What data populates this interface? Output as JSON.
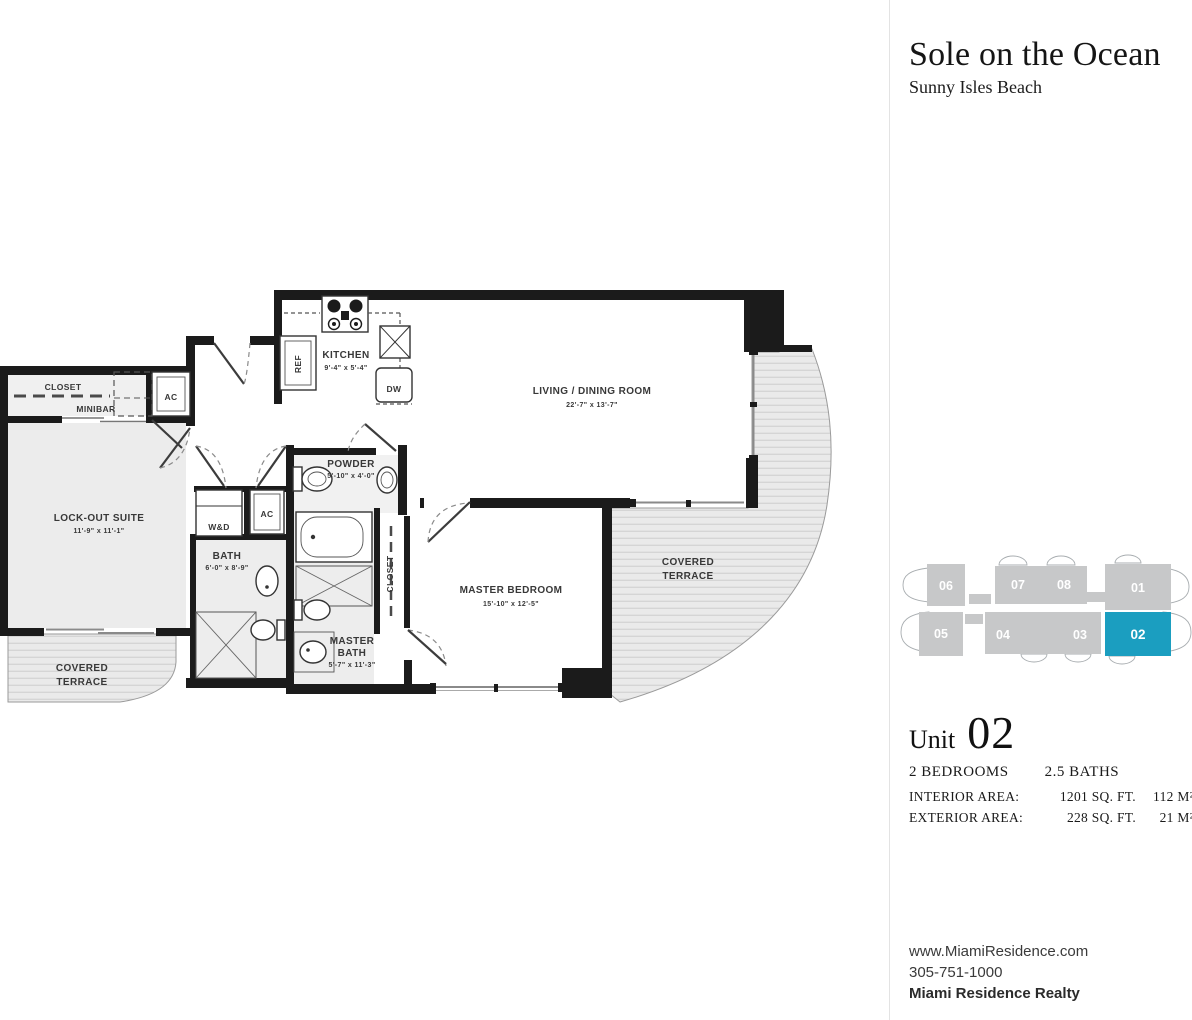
{
  "header": {
    "title": "Sole on the Ocean",
    "subtitle": "Sunny Isles Beach"
  },
  "key_plan": {
    "highlight_color": "#1B9EC0",
    "units": [
      {
        "number": "06",
        "highlighted": false
      },
      {
        "number": "07",
        "highlighted": false
      },
      {
        "number": "08",
        "highlighted": false
      },
      {
        "number": "01",
        "highlighted": false
      },
      {
        "number": "05",
        "highlighted": false
      },
      {
        "number": "04",
        "highlighted": false
      },
      {
        "number": "03",
        "highlighted": false
      },
      {
        "number": "02",
        "highlighted": true
      }
    ]
  },
  "unit_info": {
    "unit_label": "Unit",
    "unit_number": "02",
    "bedrooms": "2 BEDROOMS",
    "baths": "2.5 BATHS",
    "areas": [
      {
        "label": "INTERIOR AREA:",
        "sqft": "1201 SQ. FT.",
        "metric": "112 M²"
      },
      {
        "label": "EXTERIOR AREA:",
        "sqft": "228 SQ. FT.",
        "metric": "21 M²"
      }
    ]
  },
  "footer": {
    "website": "www.MiamiResidence.com",
    "phone": "305-751-1000",
    "company": "Miami Residence Realty"
  },
  "floorplan": {
    "rooms": {
      "entry_closet": {
        "label": "CLOSET"
      },
      "minibar": {
        "label": "MINIBAR"
      },
      "ac_closet_entry": {
        "label": "AC"
      },
      "ac_closet_hall": {
        "label": "AC"
      },
      "lockout_suite": {
        "label": "LOCK-OUT SUITE",
        "dims": "11'-9\" x 11'-1\""
      },
      "kitchen": {
        "label": "KITCHEN",
        "dims": "9'-4\" x 5'-4\""
      },
      "ref": {
        "label": "REF"
      },
      "dw": {
        "label": "DW"
      },
      "living_dining": {
        "label": "LIVING / DINING ROOM",
        "dims": "22'-7\" x 13'-7\""
      },
      "powder": {
        "label": "POWDER",
        "dims": "5'-10\" x 4'-0\""
      },
      "washer_dryer": {
        "label": "W&D"
      },
      "bath": {
        "label": "BATH",
        "dims": "6'-0\" x 8'-9\""
      },
      "master_closet": {
        "label": "CLOSET"
      },
      "master_bedroom": {
        "label": "MASTER BEDROOM",
        "dims": "15'-10\" x 12'-5\""
      },
      "master_bath": {
        "line1": "MASTER",
        "line2": "BATH",
        "dims": "5'-7\" x 11'-3\""
      },
      "terrace_right": {
        "line1": "COVERED",
        "line2": "TERRACE"
      },
      "terrace_left": {
        "line1": "COVERED",
        "line2": "TERRACE"
      }
    }
  }
}
